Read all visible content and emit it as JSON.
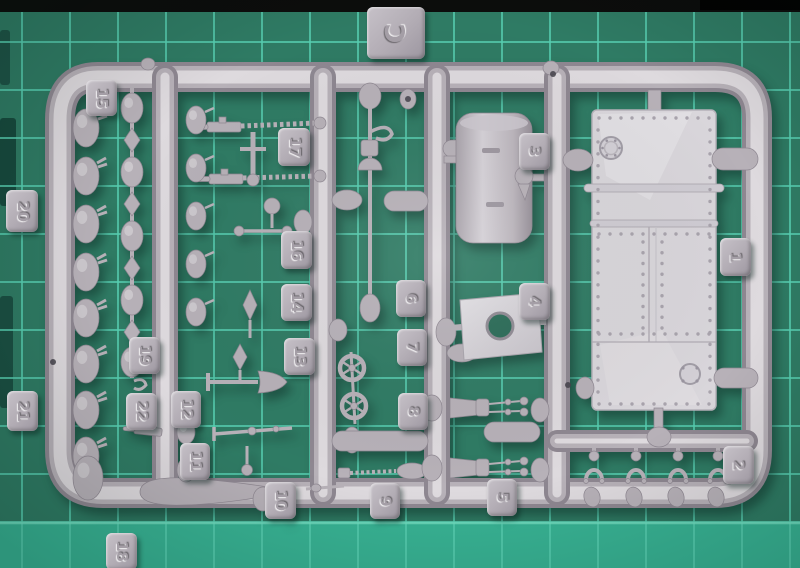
{
  "photo_alt": "Grey injection-moulded model kit sprue lettered C lying on a green self-healing cutting mat",
  "colors": {
    "mat_base": "#2f7b64",
    "mat_grid": "#57cfb1",
    "mat_bright_strip": "#39b697",
    "mat_edge_band": "#0c0d0c",
    "plastic_base": "#b7b1b8",
    "plastic_highlight": "#dedade",
    "plastic_shadow": "#8e8791",
    "panel_light": "#d9d6db"
  },
  "sprue": {
    "frame_letter": "C",
    "tags": [
      {
        "label": "C"
      },
      {
        "label": "15"
      },
      {
        "label": "20"
      },
      {
        "label": "21"
      },
      {
        "label": "18"
      },
      {
        "label": "17"
      },
      {
        "label": "16"
      },
      {
        "label": "19"
      },
      {
        "label": "22"
      },
      {
        "label": "12"
      },
      {
        "label": "11"
      },
      {
        "label": "14"
      },
      {
        "label": "13"
      },
      {
        "label": "10"
      },
      {
        "label": "9"
      },
      {
        "label": "6"
      },
      {
        "label": "7"
      },
      {
        "label": "8"
      },
      {
        "label": "3"
      },
      {
        "label": "4"
      },
      {
        "label": "5"
      },
      {
        "label": "1"
      },
      {
        "label": "2"
      }
    ],
    "parts_visible": [
      "tail-finned bombs",
      "egg-and-diamond link chain",
      "machine guns with ammo belts",
      "shovel",
      "boat hook pole",
      "hand wheels",
      "torpedo shaped tanks",
      "storage drum",
      "plate with round hole",
      "large riveted hull panel",
      "engine telegraph columns",
      "tow shackles"
    ]
  }
}
